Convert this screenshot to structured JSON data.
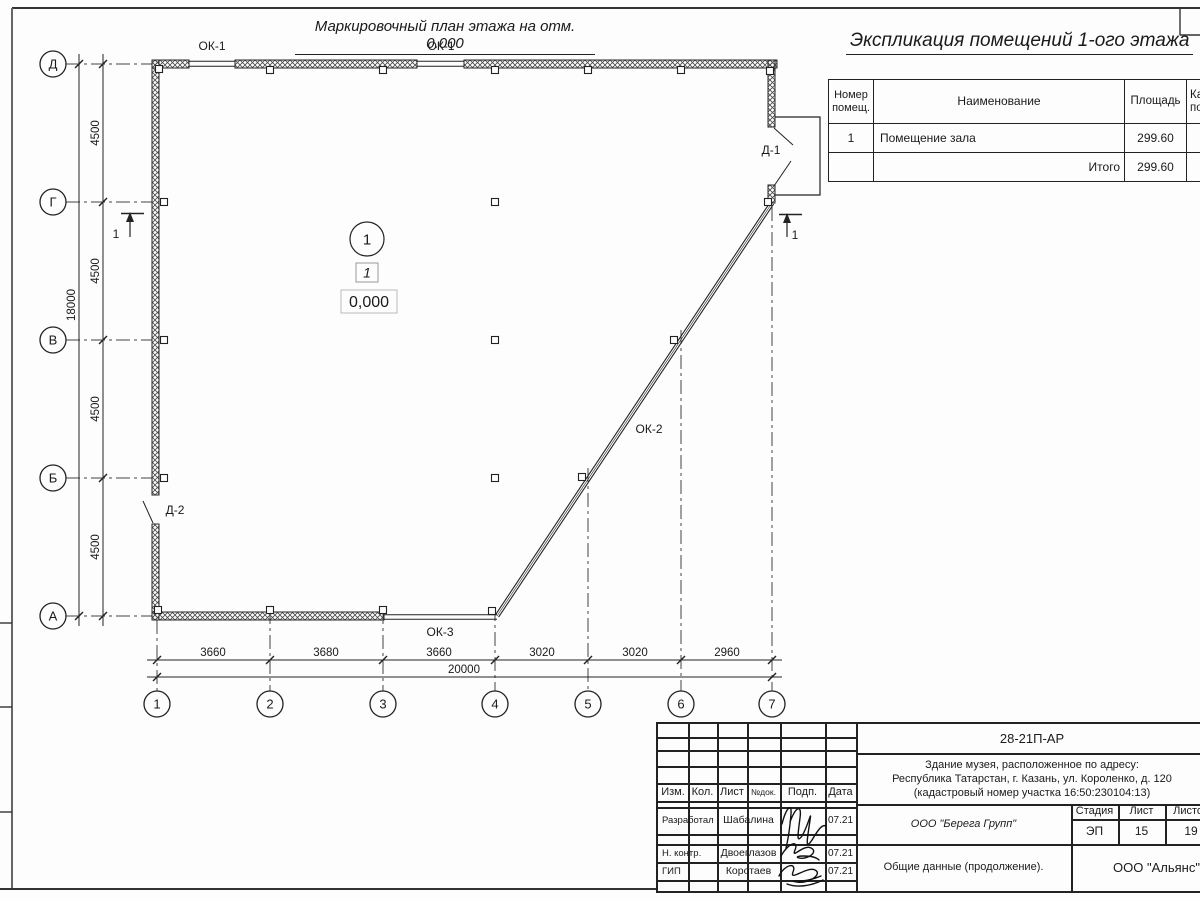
{
  "plan": {
    "title": "Маркировочный план этажа на отм. 0.000",
    "room": {
      "number": "1",
      "floor_type": "1",
      "elevation": "0,000"
    },
    "windows": {
      "ok1a": "ОК-1",
      "ok1b": "ОК-1",
      "ok2": "ОК-2",
      "ok3": "ОК-3"
    },
    "doors": {
      "d1": "Д-1",
      "d2": "Д-2"
    },
    "section": {
      "left": "1",
      "right": "1"
    },
    "axes": {
      "letters": [
        "Д",
        "Г",
        "В",
        "Б",
        "А"
      ],
      "numbers": [
        "1",
        "2",
        "3",
        "4",
        "5",
        "6",
        "7"
      ]
    },
    "dims": {
      "vertical_total": "18000",
      "vertical_segments": [
        "4500",
        "4500",
        "4500",
        "4500"
      ],
      "horizontal_segments": [
        "3660",
        "3680",
        "3660",
        "3020",
        "3020",
        "2960"
      ],
      "horizontal_total": "20000"
    },
    "line_color": "#222222",
    "paper_color": "#fdfdfd"
  },
  "explication": {
    "title": "Экспликация помещений 1-ого этажа",
    "headers": {
      "num_line1": "Номер",
      "num_line2": "помещ.",
      "name": "Наименование",
      "area": "Площадь",
      "cat_line1": "Ка",
      "cat_line2": "по"
    },
    "rows": [
      {
        "num": "1",
        "name": "Помещение зала",
        "area": "299.60"
      }
    ],
    "total_label": "Итого",
    "total_area": "299.60"
  },
  "titleblock": {
    "doc_number": "28-21П-АР",
    "address_line1": "Здание музея, расположенное по адресу:",
    "address_line2": "Республика Татарстан, г. Казань, ул. Короленко, д. 120",
    "address_line3": "(кадастровый номер участка 16:50:230104:13)",
    "developer_org": "ООО \"Берега Групп\"",
    "doc_title": "Общие данные (продолжение).",
    "customer_org": "ООО \"Альянс\"",
    "stage_label": "Стадия",
    "sheet_label": "Лист",
    "sheets_label": "Листов",
    "stage": "ЭП",
    "sheet_num": "15",
    "sheets_total": "19",
    "cols": {
      "izm": "Изм.",
      "kol": "Кол.",
      "list": "Лист",
      "ndoc": "№док.",
      "podp": "Подп.",
      "data": "Дата"
    },
    "people": [
      {
        "role": "Разработал",
        "name": "Шабалина",
        "date": "07.21"
      },
      {
        "role": "Н. контр.",
        "name": "Двоеглазов",
        "date": "07.21"
      },
      {
        "role": "ГИП",
        "name": "Коротаев",
        "date": "07.21"
      }
    ]
  }
}
